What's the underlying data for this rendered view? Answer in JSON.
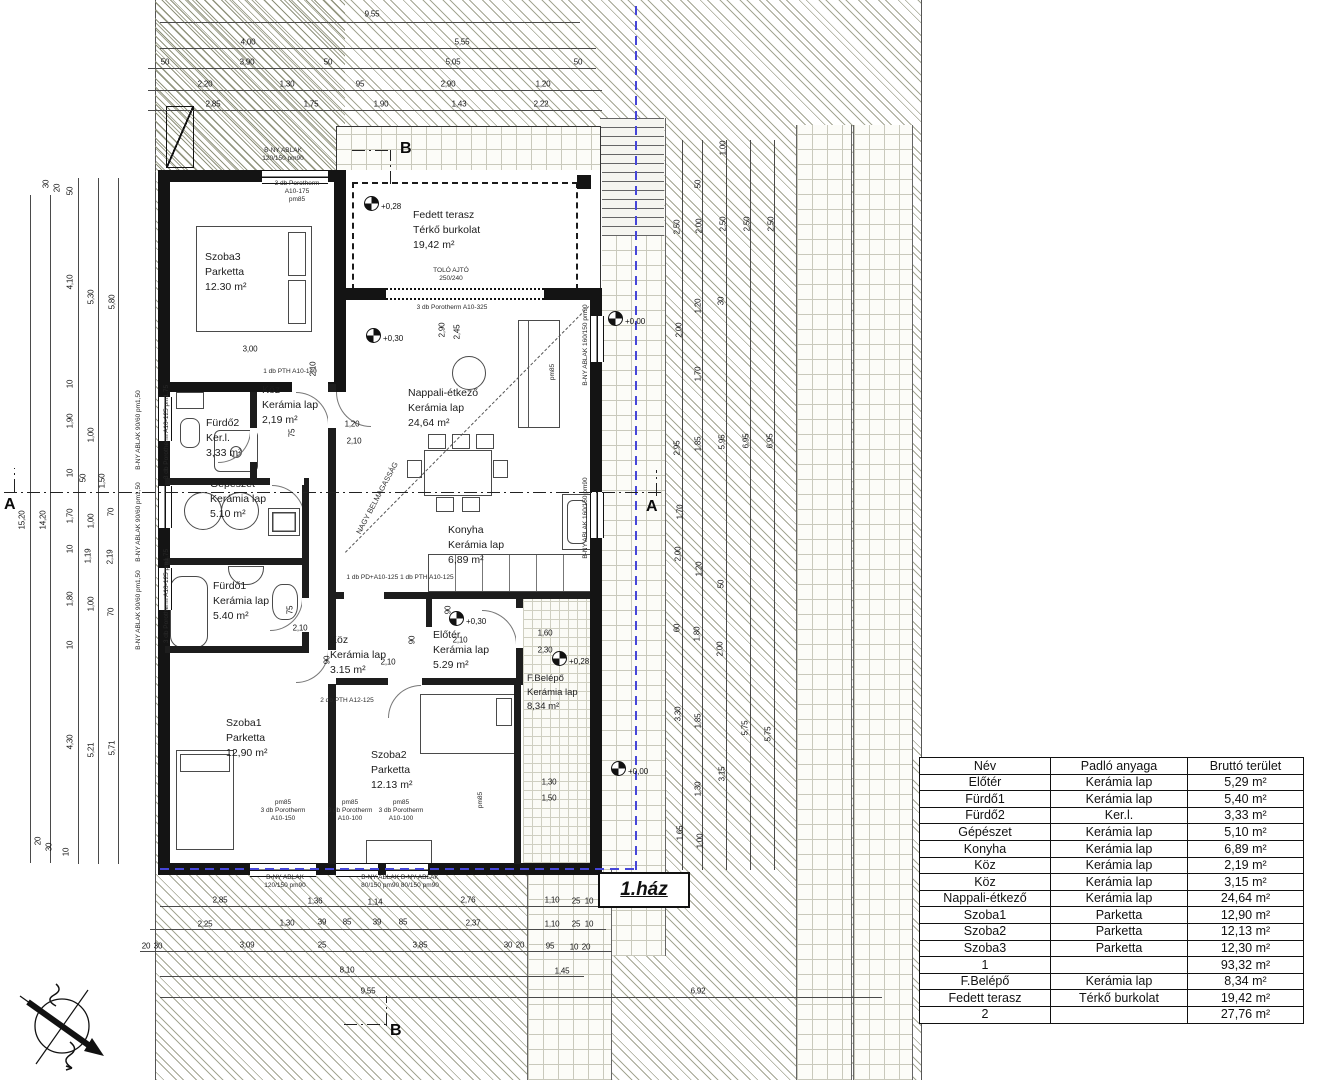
{
  "drawing": {
    "house_label": "1.ház",
    "section_markers": {
      "a": "A",
      "b": "B"
    },
    "diagonal_note": "NAGY BELMAGASSÁG",
    "levels": [
      "+0,28",
      "+0,30",
      "+0,30",
      "+0,28",
      "+0,00",
      "+0,00"
    ],
    "rooms": [
      {
        "name": "Szoba3",
        "material": "Parketta",
        "area": "12.30 m²"
      },
      {
        "name": "Fedett terasz",
        "material": "Térkő burkolat",
        "area": "19,42 m²"
      },
      {
        "name": "Nappali-étkező",
        "material": "Kerámia lap",
        "area": "24,64 m²"
      },
      {
        "name": "Konyha",
        "material": "Kerámia lap",
        "area": "6,89 m²"
      },
      {
        "name": "Köz",
        "material": "Kerámia lap",
        "area": "2,19 m²"
      },
      {
        "name": "Fürdő2",
        "material": "Ker.l.",
        "area": "3,33 m²"
      },
      {
        "name": "Gépészet",
        "material": "Kerámia lap",
        "area": "5.10 m²"
      },
      {
        "name": "Fürdő1",
        "material": "Kerámia lap",
        "area": "5.40 m²"
      },
      {
        "name": "Köz",
        "material": "Kerámia lap",
        "area": "3.15 m²"
      },
      {
        "name": "Előtér",
        "material": "Kerámia lap",
        "area": "5.29 m²"
      },
      {
        "name": "Szoba1",
        "material": "Parketta",
        "area": "12,90 m²"
      },
      {
        "name": "Szoba2",
        "material": "Parketta",
        "area": "12.13 m²"
      },
      {
        "name": "F.Belépő",
        "material": "Kerámia lap",
        "area": "8,34 m²"
      }
    ],
    "notes": [
      "B-NY ABLAK",
      "120/150 pm90",
      "3 db Porotherm",
      "A10-175",
      "pm85",
      "3 db Porotherm  A10-325",
      "B-NY ABLAK 90/60 pm1,50",
      "3 db Porotherm A10-125 pm1,75",
      "B-NY ABLAK 160/150 pm90",
      "80/150 pm90  80/150 pm90",
      "A10-150",
      "A10-100",
      "1 db PTH A10-140",
      "2 db PTH A12-125",
      "1 db PD+A10-125  1 db PTH A10-125",
      "B-NY ABLAK  B-NY ABLAK",
      "TOLÓ AJTÓ",
      "250/240",
      "NAGY BELMAGASSÁG"
    ]
  },
  "dims": {
    "top": [
      "9,55",
      "4,00",
      "5,55",
      "50",
      "3,90",
      "50",
      "5,05",
      "50",
      "2,20",
      "1,30",
      "95",
      "2,90",
      "1,20",
      "2,85",
      "1,75",
      "1,90",
      "1,43",
      "2,22"
    ],
    "left": [
      "15,20",
      "14,20",
      "30",
      "20",
      "50",
      "4,10",
      "5,30",
      "5,80",
      "10",
      "1,90",
      "1,00",
      "10",
      "50",
      "1,50",
      "1,70",
      "1,00",
      "70",
      "10",
      "1,19",
      "2,19",
      "1,80",
      "1,00",
      "70",
      "10",
      "4,30",
      "5,21",
      "5,71",
      "20",
      "30",
      "10"
    ],
    "right": [
      "1,00",
      "50",
      "2,50",
      "2,00",
      "2,50",
      "2,50",
      "2,50",
      "2,00",
      "1,20",
      "30",
      "1,70",
      "2,95",
      "1,85",
      "5,95",
      "6,95",
      "6,95",
      "1,70",
      "2,00",
      "1,20",
      "50",
      "60",
      "1,80",
      "2,00",
      "3,30",
      "1,85",
      "3,15",
      "1,30",
      "1,65",
      "1,00",
      "5,75",
      "5,75"
    ],
    "bottom": [
      "2,85",
      "1,36",
      "1,14",
      "2,76",
      "1,10",
      "25",
      "10",
      "2,25",
      "1,30",
      "39",
      "85",
      "39",
      "85",
      "2,37",
      "1,10",
      "25",
      "10",
      "20",
      "30",
      "3,09",
      "25",
      "3,85",
      "30",
      "20",
      "95",
      "10",
      "20",
      "8,10",
      "1,45",
      "9,55",
      "6,92"
    ],
    "inner": [
      "3,00",
      "2,90",
      "2,45",
      "2,10",
      "1,20",
      "2,10",
      "75",
      "75",
      "2,10",
      "90",
      "2,10",
      "90",
      "1,60",
      "2,30",
      "1,30",
      "1,50",
      "90",
      "2,10"
    ]
  },
  "table": {
    "headers": [
      "Név",
      "Padló anyaga",
      "Bruttó terület"
    ],
    "rows": [
      [
        "Előtér",
        "Kerámia lap",
        "5,29 m²"
      ],
      [
        "Fürdő1",
        "Kerámia lap",
        "5,40 m²"
      ],
      [
        "Fürdő2",
        "Ker.l.",
        "3,33 m²"
      ],
      [
        "Gépészet",
        "Kerámia lap",
        "5,10 m²"
      ],
      [
        "Konyha",
        "Kerámia lap",
        "6,89 m²"
      ],
      [
        "Köz",
        "Kerámia lap",
        "2,19 m²"
      ],
      [
        "Köz",
        "Kerámia lap",
        "3,15 m²"
      ],
      [
        "Nappali-étkező",
        "Kerámia lap",
        "24,64 m²"
      ],
      [
        "Szoba1",
        "Parketta",
        "12,90 m²"
      ],
      [
        "Szoba2",
        "Parketta",
        "12,13 m²"
      ],
      [
        "Szoba3",
        "Parketta",
        "12,30 m²"
      ],
      [
        "1",
        "",
        "93,32 m²"
      ],
      [
        "F.Belépő",
        "Kerámia lap",
        "8,34 m²"
      ],
      [
        "Fedett terasz",
        "Térkő burkolat",
        "19,42 m²"
      ],
      [
        "2",
        "",
        "27,76 m²"
      ]
    ]
  }
}
